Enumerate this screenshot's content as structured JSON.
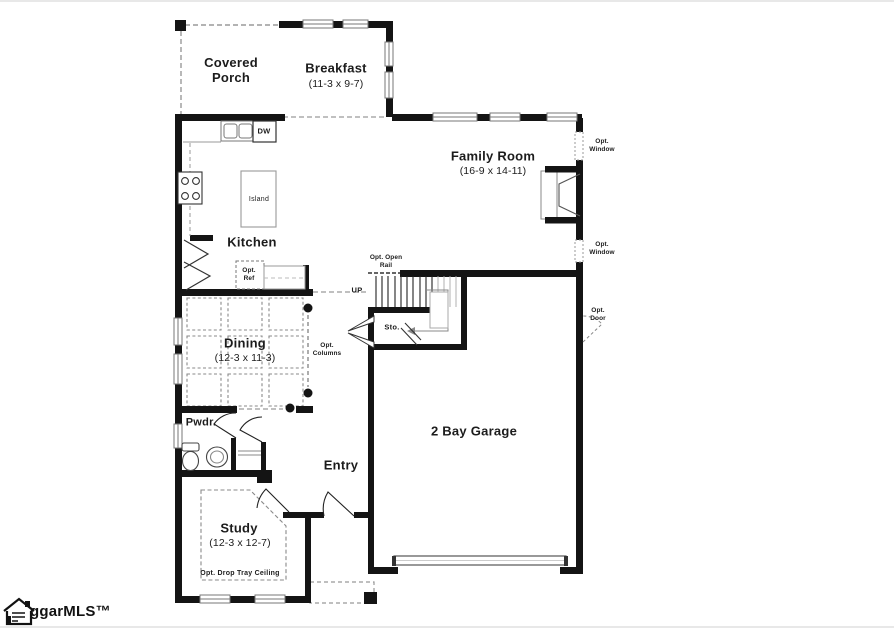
{
  "rooms": {
    "covered_porch": {
      "name": "Covered Porch"
    },
    "breakfast": {
      "name": "Breakfast",
      "dims": "(11-3 x 9-7)"
    },
    "family_room": {
      "name": "Family Room",
      "dims": "(16-9 x 14-11)"
    },
    "kitchen": {
      "name": "Kitchen"
    },
    "island": {
      "name": "Island"
    },
    "dining": {
      "name": "Dining",
      "dims": "(12-3 x 11-3)"
    },
    "powder": {
      "name": "Pwdr."
    },
    "entry": {
      "name": "Entry"
    },
    "garage": {
      "name": "2 Bay Garage"
    },
    "study": {
      "name": "Study",
      "dims": "(12-3 x 12-7)",
      "ceiling_note": "Opt. Drop Tray Ceiling"
    },
    "storage": {
      "name": "Sto."
    }
  },
  "annotations": {
    "up": "UP",
    "dishwasher": "DW",
    "opt_ref": "Opt. Ref",
    "opt_columns": "Opt. Columns",
    "opt_open_rail": "Opt. Open Rail",
    "opt_window": "Opt. Window",
    "opt_door": "Opt. Door"
  },
  "watermark": {
    "logo_text": "ggarMLS™"
  },
  "colors": {
    "wall": "#141414",
    "background": "#ffffff",
    "dashed_line": "#999999",
    "text": "#1c1c1c"
  }
}
